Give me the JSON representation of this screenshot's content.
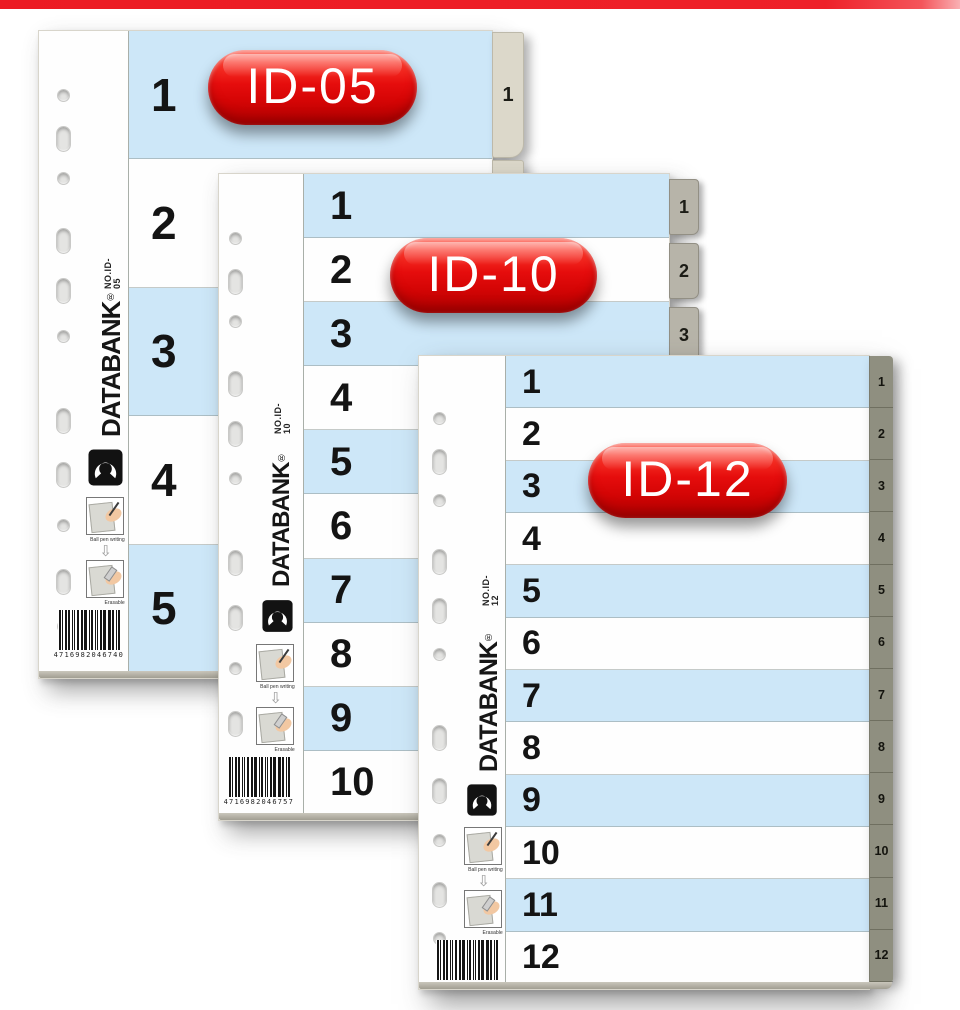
{
  "page": {
    "top_bar_color": "#ed1c24",
    "background": "#ffffff"
  },
  "brand": {
    "name": "DATABANK",
    "registered_mark": "®",
    "instruction_top_caption": "Ball pen writing",
    "instruction_bottom_caption": "Erasable",
    "down_arrow_icon": "⇩"
  },
  "products": [
    {
      "id": "id-05",
      "badge_label": "ID-05",
      "model_no": "NO.ID-05",
      "barcode_digits": "4716982046740",
      "row_labels": [
        "1",
        "2",
        "3",
        "4",
        "5"
      ],
      "tab_labels": [
        "1",
        "2",
        "3",
        "4",
        "5"
      ]
    },
    {
      "id": "id-10",
      "badge_label": "ID-10",
      "model_no": "NO.ID-10",
      "barcode_digits": "4716982046757",
      "row_labels": [
        "1",
        "2",
        "3",
        "4",
        "5",
        "6",
        "7",
        "8",
        "9",
        "10"
      ],
      "tab_labels": [
        "1",
        "2",
        "3",
        "4",
        "5",
        "6",
        "7",
        "8",
        "9",
        "10"
      ]
    },
    {
      "id": "id-12",
      "badge_label": "ID-12",
      "model_no": "NO.ID-12",
      "barcode_digits": "4716982046764",
      "row_labels": [
        "1",
        "2",
        "3",
        "4",
        "5",
        "6",
        "7",
        "8",
        "9",
        "10",
        "11",
        "12"
      ],
      "tab_labels": [
        "1",
        "2",
        "3",
        "4",
        "5",
        "6",
        "7",
        "8",
        "9",
        "10",
        "11",
        "12"
      ]
    }
  ],
  "colors": {
    "top_bar_red": "#ed1c24",
    "badge_red": "#e60d0d",
    "row_blue": "#cde7f8",
    "row_white": "#ffffff",
    "tab_beige": "#dcd8ca",
    "tab_gray": "#b7b4a9",
    "tab_strip_olive": "#8f8f80"
  }
}
